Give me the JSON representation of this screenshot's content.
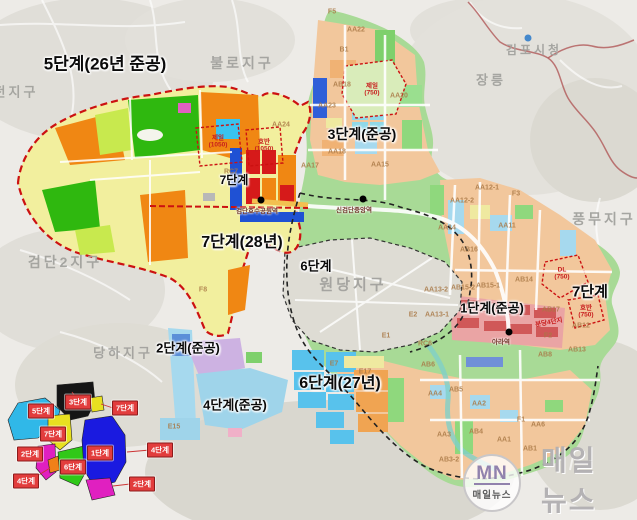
{
  "watermark": {
    "logo_initials": "MN",
    "logo_name": "매일뉴스",
    "big_text": "매일뉴스"
  },
  "map": {
    "phase_labels": [
      {
        "id": "phase-5",
        "text": "5단계(26년 준공)",
        "x": 105,
        "y": 64,
        "fs": 17
      },
      {
        "id": "phase-3",
        "text": "3단계(준공)",
        "x": 362,
        "y": 134,
        "fs": 14
      },
      {
        "id": "phase-7-top",
        "text": "7단계",
        "x": 234,
        "y": 180,
        "fs": 12
      },
      {
        "id": "phase-7-west",
        "text": "7단계(28년)",
        "x": 242,
        "y": 243,
        "fs": 16
      },
      {
        "id": "phase-6-mid",
        "text": "6단계",
        "x": 316,
        "y": 266,
        "fs": 13
      },
      {
        "id": "phase-1",
        "text": "1단계(준공)",
        "x": 492,
        "y": 308,
        "fs": 13
      },
      {
        "id": "phase-7-east",
        "text": "7단계",
        "x": 590,
        "y": 292,
        "fs": 15
      },
      {
        "id": "phase-2",
        "text": "2단계(준공)",
        "x": 188,
        "y": 348,
        "fs": 13
      },
      {
        "id": "phase-4",
        "text": "4단계(준공)",
        "x": 235,
        "y": 405,
        "fs": 13
      },
      {
        "id": "phase-6-south",
        "text": "6단계(27년)",
        "x": 340,
        "y": 384,
        "fs": 16
      }
    ],
    "district_labels": [
      {
        "text": "불로지구",
        "x": 242,
        "y": 63,
        "fs": 14
      },
      {
        "text": "김포시청",
        "x": 534,
        "y": 50,
        "fs": 12
      },
      {
        "text": "장릉",
        "x": 491,
        "y": 80,
        "fs": 13
      },
      {
        "text": "전지구",
        "x": 16,
        "y": 92,
        "fs": 13
      },
      {
        "text": "검단2지구",
        "x": 65,
        "y": 262,
        "fs": 14
      },
      {
        "text": "당하지구",
        "x": 123,
        "y": 353,
        "fs": 13
      },
      {
        "text": "원당지구",
        "x": 353,
        "y": 285,
        "fs": 15
      },
      {
        "text": "풍무지구",
        "x": 604,
        "y": 219,
        "fs": 14
      }
    ],
    "block_codes": [
      {
        "text": "F5",
        "x": 332,
        "y": 12
      },
      {
        "text": "AA22",
        "x": 356,
        "y": 30
      },
      {
        "text": "B1",
        "x": 344,
        "y": 50
      },
      {
        "text": "AB18",
        "x": 342,
        "y": 85
      },
      {
        "text": "AA20",
        "x": 399,
        "y": 96
      },
      {
        "text": "AA23",
        "x": 327,
        "y": 106
      },
      {
        "text": "AA24",
        "x": 281,
        "y": 125
      },
      {
        "text": "AA18",
        "x": 337,
        "y": 152
      },
      {
        "text": "AA15",
        "x": 380,
        "y": 165
      },
      {
        "text": "AA17",
        "x": 310,
        "y": 166
      },
      {
        "text": "RC7",
        "x": 231,
        "y": 172
      },
      {
        "text": "AA12-1",
        "x": 487,
        "y": 188
      },
      {
        "text": "F3",
        "x": 516,
        "y": 194
      },
      {
        "text": "AA12-2",
        "x": 462,
        "y": 201
      },
      {
        "text": "AA14",
        "x": 447,
        "y": 228
      },
      {
        "text": "AA11",
        "x": 507,
        "y": 226
      },
      {
        "text": "AB16",
        "x": 469,
        "y": 250
      },
      {
        "text": "AB14",
        "x": 524,
        "y": 280
      },
      {
        "text": "AB15-1",
        "x": 488,
        "y": 286
      },
      {
        "text": "AB15-2",
        "x": 463,
        "y": 288
      },
      {
        "text": "AA13-2",
        "x": 436,
        "y": 290
      },
      {
        "text": "F8",
        "x": 203,
        "y": 290
      },
      {
        "text": "AA13-1",
        "x": 437,
        "y": 315
      },
      {
        "text": "E2",
        "x": 413,
        "y": 315
      },
      {
        "text": "E1",
        "x": 386,
        "y": 336
      },
      {
        "text": "RC6",
        "x": 425,
        "y": 344
      },
      {
        "text": "E7",
        "x": 334,
        "y": 364
      },
      {
        "text": "E17",
        "x": 365,
        "y": 372
      },
      {
        "text": "E15",
        "x": 174,
        "y": 427
      },
      {
        "text": "AB17",
        "x": 551,
        "y": 310
      },
      {
        "text": "AB12",
        "x": 581,
        "y": 326
      },
      {
        "text": "F2",
        "x": 548,
        "y": 336
      },
      {
        "text": "AB13",
        "x": 577,
        "y": 350
      },
      {
        "text": "AB8",
        "x": 545,
        "y": 355
      },
      {
        "text": "AB6",
        "x": 428,
        "y": 365
      },
      {
        "text": "AB5",
        "x": 456,
        "y": 390
      },
      {
        "text": "AA4",
        "x": 435,
        "y": 394
      },
      {
        "text": "AA2",
        "x": 479,
        "y": 404
      },
      {
        "text": "F1",
        "x": 521,
        "y": 420
      },
      {
        "text": "AA6",
        "x": 538,
        "y": 425
      },
      {
        "text": "AB4",
        "x": 476,
        "y": 432
      },
      {
        "text": "AA3",
        "x": 444,
        "y": 435
      },
      {
        "text": "AA1",
        "x": 504,
        "y": 440
      },
      {
        "text": "AB1",
        "x": 530,
        "y": 449
      },
      {
        "text": "AB3-2",
        "x": 449,
        "y": 460
      }
    ],
    "parcel_labels": [
      {
        "line1": "제일",
        "line2": "(750)",
        "x": 372,
        "y": 90
      },
      {
        "line1": "제일",
        "line2": "(1050)",
        "x": 218,
        "y": 142
      },
      {
        "line1": "호반",
        "line2": "(1050)",
        "x": 264,
        "y": 146
      },
      {
        "line1": "DL",
        "line2": "(750)",
        "x": 562,
        "y": 274
      },
      {
        "line1": "호반",
        "line2": "(750)",
        "x": 586,
        "y": 312
      },
      {
        "line1": "분당4단지",
        "line2": "",
        "x": 549,
        "y": 323,
        "rot": -10
      }
    ],
    "stations": [
      {
        "name": "검단호수공원역",
        "x": 261,
        "y": 200,
        "lx": 257,
        "ly": 212
      },
      {
        "name": "신검단중앙역",
        "x": 363,
        "y": 199,
        "lx": 354,
        "ly": 211
      },
      {
        "name": "아라역",
        "x": 509,
        "y": 332,
        "lx": 501,
        "ly": 343
      }
    ]
  },
  "inset": {
    "labels": [
      {
        "text": "3단계",
        "x": 78,
        "y": 402
      },
      {
        "text": "5단계",
        "x": 41,
        "y": 411
      },
      {
        "text": "7단계",
        "x": 125,
        "y": 408
      },
      {
        "text": "7단계",
        "x": 53,
        "y": 434
      },
      {
        "text": "2단계",
        "x": 30,
        "y": 454
      },
      {
        "text": "1단계",
        "x": 100,
        "y": 453
      },
      {
        "text": "4단계",
        "x": 160,
        "y": 450
      },
      {
        "text": "6단계",
        "x": 73,
        "y": 467
      },
      {
        "text": "4단계",
        "x": 26,
        "y": 481
      },
      {
        "text": "2단계",
        "x": 142,
        "y": 484
      }
    ],
    "colors": {
      "phase1": "#1a1ae0",
      "phase2": "#e020c0",
      "phase3": "#151515",
      "phase4": "#f08018",
      "phase5": "#30b8e8",
      "phase6": "#30c818",
      "phase7": "#e8e020"
    }
  },
  "colors": {
    "boundary_red_dashed": "#cc1111",
    "boundary_black_dashed": "#222222",
    "gimpo_boundary": "#b05858",
    "inset_label_box": "#e23d3d",
    "station_dot": "#000000",
    "city_hall_marker": "#4488cc"
  }
}
